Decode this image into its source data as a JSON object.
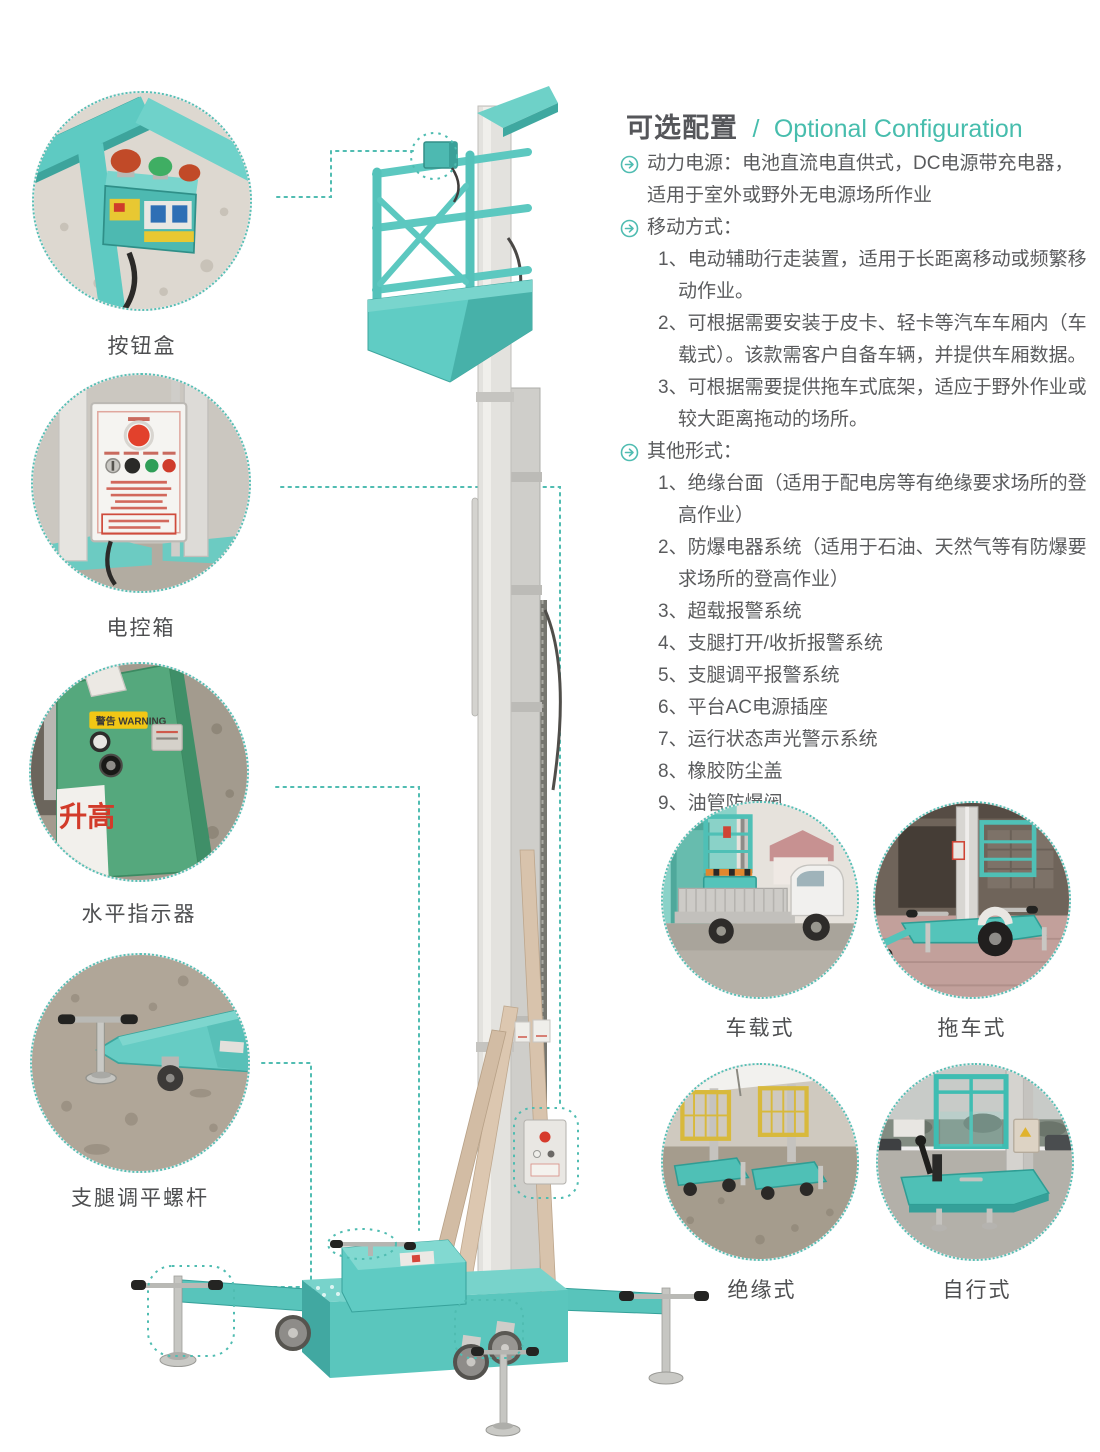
{
  "header": {
    "title_zh": "可选配置",
    "separator": "/",
    "title_en": "Optional Configuration"
  },
  "optional_config": {
    "bullets": [
      {
        "label": "动力电源：电池直流电直供式，DC电源带充电器，适用于室外或野外无电源场所作业",
        "items": []
      },
      {
        "label": "移动方式：",
        "items": [
          "1、电动辅助行走装置，适用于长距离移动或频繁移动作业。",
          "2、可根据需要安装于皮卡、轻卡等汽车车厢内（车载式）。该款需客户自备车辆，并提供车厢数据。",
          "3、可根据需要提供拖车式底架，适应于野外作业或较大距离拖动的场所。"
        ]
      },
      {
        "label": "其他形式：",
        "items": [
          "1、绝缘台面（适用于配电房等有绝缘要求场所的登高作业）",
          "2、防爆电器系统（适用于石油、天然气等有防爆要求场所的登高作业）",
          "3、超载报警系统",
          "4、支腿打开/收折报警系统",
          "5、支腿调平报警系统",
          "6、平台AC电源插座",
          "7、运行状态声光警示系统",
          "8、橡胶防尘盖",
          "9、油管防爆阀"
        ]
      }
    ]
  },
  "detail_callouts": [
    {
      "label": "按钮盒"
    },
    {
      "label": "电控箱"
    },
    {
      "label": "水平指示器"
    },
    {
      "label": "支腿调平螺杆"
    }
  ],
  "variant_gallery": [
    {
      "label": "车载式"
    },
    {
      "label": "拖车式"
    },
    {
      "label": "绝缘式"
    },
    {
      "label": "自行式"
    }
  ],
  "photo_texts": {
    "warning_sticker": "警告 WARNING",
    "raise_text": "升高"
  },
  "colors": {
    "accent_teal": "#47bdad",
    "machine_teal": "#5fcbc3",
    "dashed_line": "#4fbcb1",
    "text_dark": "#58595b"
  }
}
